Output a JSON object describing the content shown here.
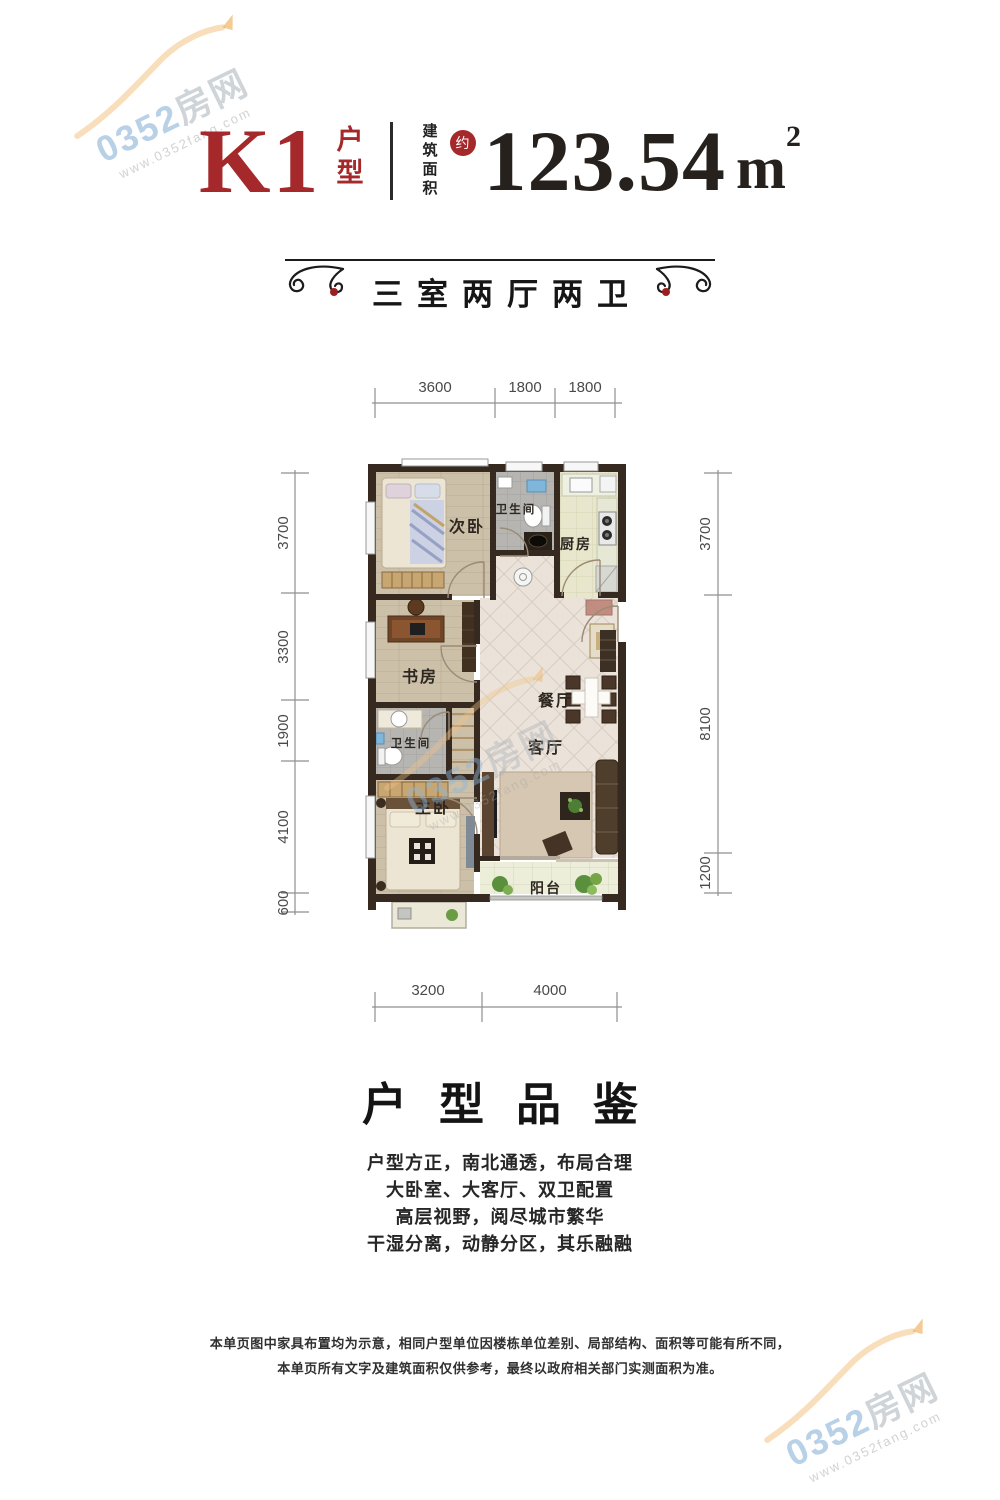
{
  "watermark": {
    "brand_num": "0352",
    "brand_cn": "房网",
    "url": "www.0352fang.com"
  },
  "title": {
    "unit_code": "K1",
    "unit_label": "户型",
    "area_label": "建筑面积",
    "approx_badge": "约",
    "area_value": "123.54",
    "area_unit": "m",
    "area_exponent": "2"
  },
  "banner": {
    "text": "三室两厅两卫"
  },
  "floorplan": {
    "dims_top": [
      "3600",
      "1800",
      "1800"
    ],
    "dims_bottom": [
      "3200",
      "4000"
    ],
    "dims_left": [
      "3700",
      "3300",
      "1900",
      "4100",
      "600"
    ],
    "dims_right": [
      "3700",
      "8100",
      "1200"
    ],
    "rooms": {
      "bedroom2": "次卧",
      "bath1": "卫生间",
      "kitchen": "厨房",
      "study": "书房",
      "dining": "餐厅",
      "living": "客厅",
      "bath2": "卫生间",
      "master": "主卧",
      "balcony": "阳台"
    }
  },
  "details": {
    "heading": "户型品鉴",
    "lines": [
      "户型方正，南北通透，布局合理",
      "大卧室、大客厅、双卫配置",
      "高层视野，阅尽城市繁华",
      "干湿分离，动静分区，其乐融融"
    ]
  },
  "disclaimer": {
    "line1": "本单页图中家具布置均为示意，相同户型单位因楼栋单位差别、局部结构、面积等可能有所不同，",
    "line2": "本单页所有文字及建筑面积仅供参考，最终以政府相关部门实测面积为准。"
  }
}
